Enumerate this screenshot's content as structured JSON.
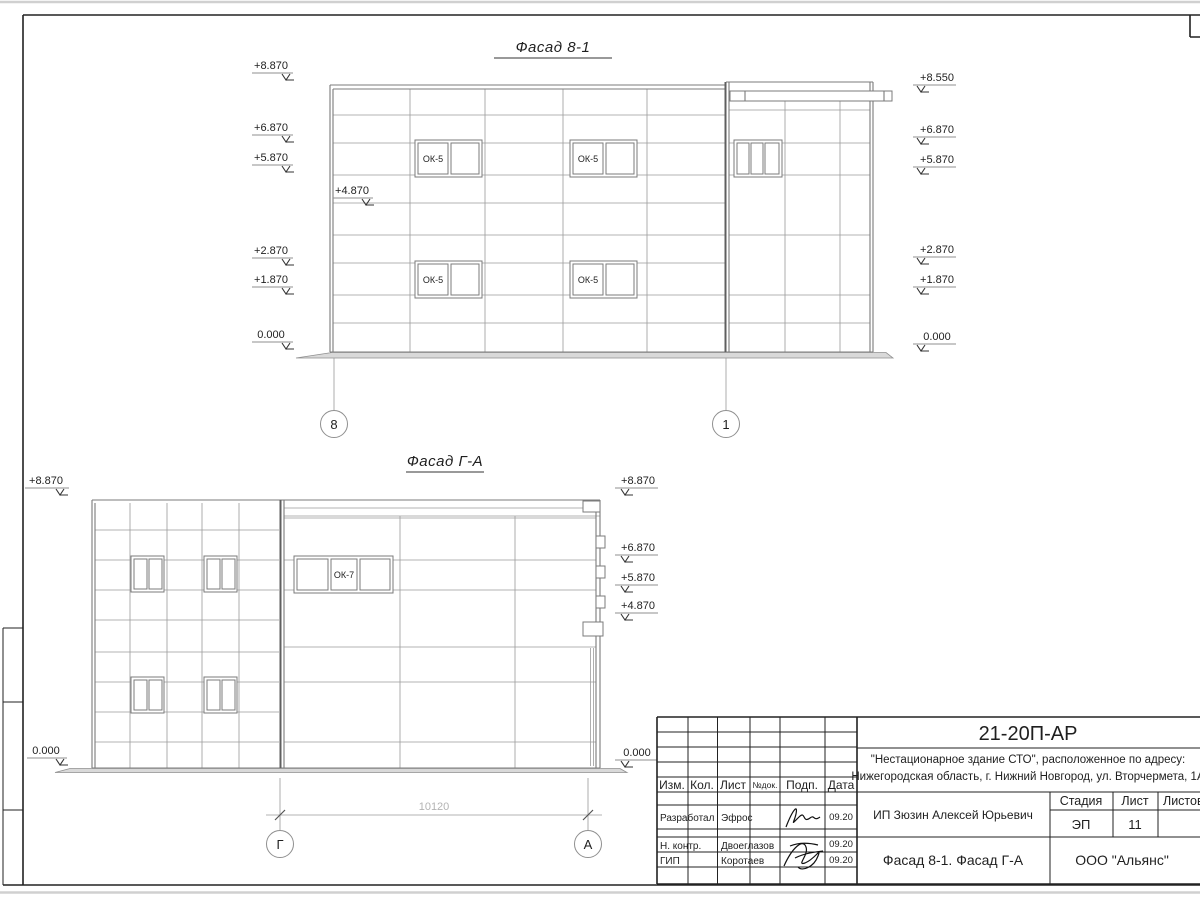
{
  "facade1": {
    "title": "Фасад 8-1",
    "window_label": "ОК-5",
    "marks_left": [
      "+8.870",
      "+6.870",
      "+5.870",
      "+2.870",
      "+1.870",
      "0.000"
    ],
    "mark_inner": "+4.870",
    "marks_right": [
      "+8.550",
      "+6.870",
      "+5.870",
      "+2.870",
      "+1.870",
      "0.000"
    ],
    "axis_left": "8",
    "axis_right": "1"
  },
  "facade2": {
    "title": "Фасад Г-А",
    "window_label": "ОК-7",
    "marks_left": [
      "+8.870",
      "0.000"
    ],
    "marks_right": [
      "+8.870",
      "+6.870",
      "+5.870",
      "+4.870",
      "0.000"
    ],
    "axis_left": "Г",
    "axis_right": "А",
    "dimension": "10120"
  },
  "titleblock": {
    "doc_code": "21-20П-АР",
    "project_line1": "\"Нестационарное здание СТО\", расположенное по адресу:",
    "project_line2": "Нижегородская область, г. Нижний Новгород, ул. Вторчермета, 1А",
    "header_cols": [
      "Изм.",
      "Кол.",
      "Лист",
      "№док.",
      "Подп.",
      "Дата"
    ],
    "roles": [
      {
        "role": "Разработал",
        "name": "Эфрос",
        "date": "09.20"
      },
      {
        "role": "Н. контр.",
        "name": "Двоеглазов",
        "date": "09.20"
      },
      {
        "role": "ГИП",
        "name": "Коротаев",
        "date": "09.20"
      }
    ],
    "client": "ИП Зюзин Алексей Юрьевич",
    "stage_label": "Стадия",
    "sheet_label": "Лист",
    "sheets_label": "Листов",
    "stage_value": "ЭП",
    "sheet_value": "11",
    "drawing_title": "Фасад 8-1. Фасад Г-А",
    "company": "ООО \"Альянс\""
  }
}
